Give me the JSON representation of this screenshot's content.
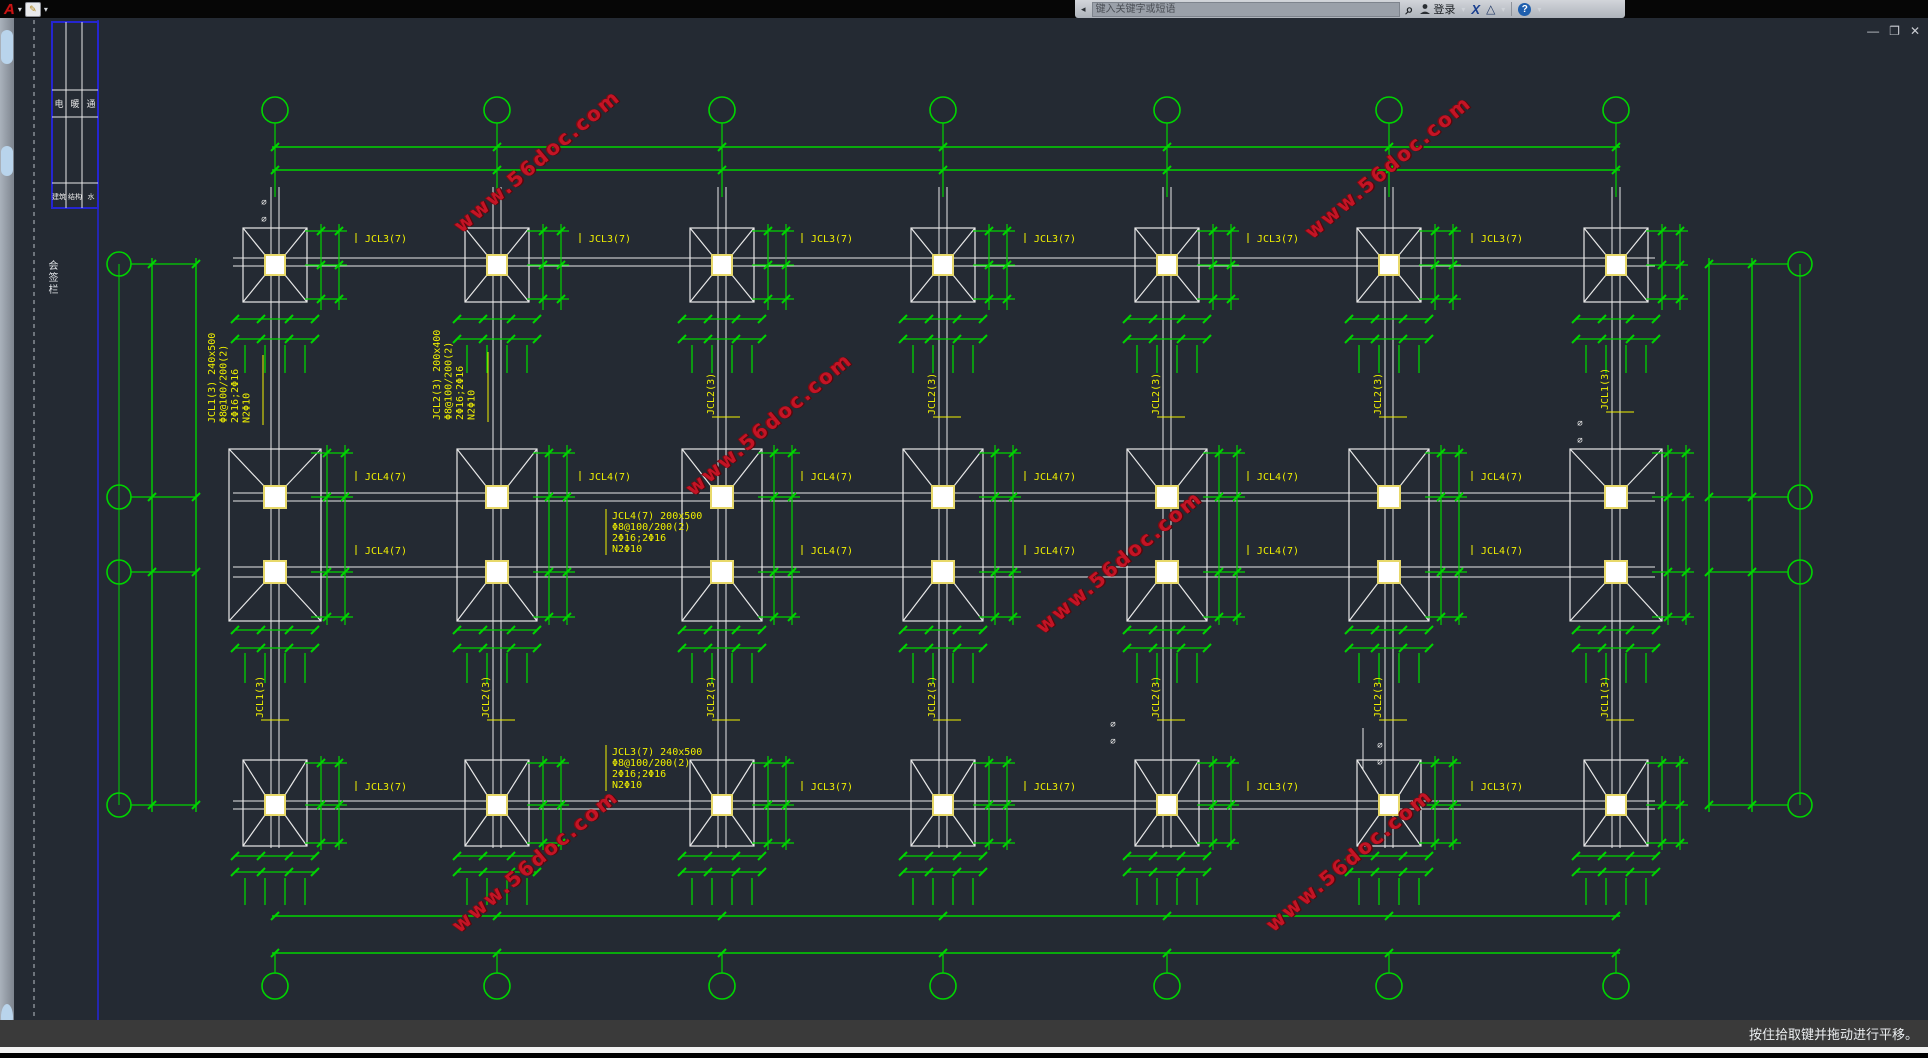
{
  "app": {
    "logo_letter": "A",
    "caret": "▾",
    "quick_icon": "✎",
    "window_controls": {
      "minimize": "—",
      "restore": "❐",
      "close": "✕"
    }
  },
  "infocenter": {
    "collapse_arrow": "◂",
    "search_placeholder": "键入关键字或短语",
    "search_icon": "⌕",
    "user_icon": "👤",
    "login_label": "登录",
    "exchange_glyph": "X",
    "a360_glyph": "△",
    "help_glyph": "?"
  },
  "statusbar": {
    "hint": "按住拾取键并拖动进行平移。"
  },
  "watermark": {
    "text": "www.56doc.com",
    "color": "#c41425"
  },
  "drawing": {
    "beam_labels": {
      "top_beam": "JCL3(7)",
      "mid_beam": "JCL4(7)",
      "end_span": "JCL1(3)",
      "inner_span": "JCL2(3)"
    },
    "blocks": {
      "jcl4": [
        "JCL4(7) 200x500",
        "Φ8@100/200(2)",
        "2Φ16;2Φ16",
        "N2Φ10"
      ],
      "jcl3": [
        "JCL3(7) 240x500",
        "Φ8@100/200(2)",
        "2Φ16;2Φ16",
        "N2Φ10"
      ],
      "jcl1": [
        "JCL1(3) 240x500",
        "Φ8@100/200(2)",
        "2Φ16;2Φ16",
        "N2Φ10"
      ],
      "jcl2": [
        "JCL2(3) 200x400",
        "Φ8@100/200(2)",
        "2Φ16;2Φ16",
        "N2Φ10"
      ]
    },
    "titleblock": {
      "row1": [
        "电",
        "暖",
        "通"
      ],
      "row2": [
        "建筑",
        "结构",
        "水"
      ],
      "caption": "会签栏"
    },
    "section_mark": "⌀",
    "colors": {
      "line_green": "#00d400",
      "line_white": "#e8e8e8",
      "label_yellow": "#f0f000",
      "selection_blue": "#2525d0",
      "canvas_bg": "#242a33",
      "watermark_red": "#c41425"
    }
  }
}
